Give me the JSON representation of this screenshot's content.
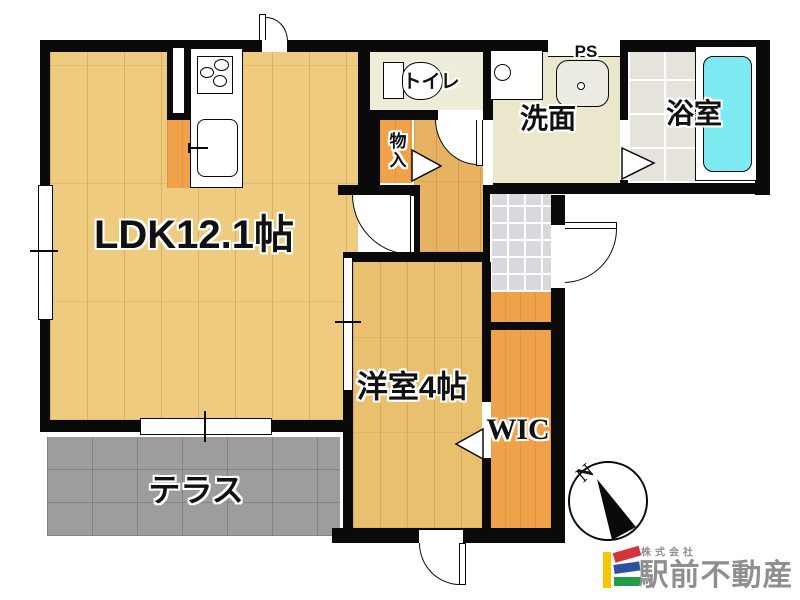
{
  "floorplan": {
    "rooms": {
      "ldk": {
        "label": "LDK12.1帖",
        "floor_type": "wood"
      },
      "western_room": {
        "label": "洋室4帖",
        "floor_type": "wood"
      },
      "wic": {
        "label": "WIC",
        "floor_type": "closet-wood"
      },
      "storage": {
        "label": "物入",
        "floor_type": "closet-wood"
      },
      "toilet": {
        "label": "トイレ"
      },
      "washroom": {
        "label": "洗面"
      },
      "bathroom": {
        "label": "浴室"
      },
      "pipe_space": {
        "label": "PS"
      },
      "terrace": {
        "label": "テラス"
      }
    },
    "fixtures": [
      "gas-stove-3-burner",
      "kitchen-sink",
      "kitchen-cabinet",
      "toilet-bowl",
      "washing-machine-pan",
      "vanity-basin",
      "bathtub",
      "shoe-cabinet",
      "sliding-door",
      "hinged-doors",
      "folding-door-triangles",
      "windows"
    ],
    "compass": {
      "north_label": "N"
    },
    "colors": {
      "wall": "#0a0a0a",
      "ldk_floor": "#eecb7e",
      "hall_floor": "#e7b261",
      "western_floor": "#e9c16e",
      "closet_orange": "#f0a24b",
      "toilet_floor": "#efecd9",
      "washroom_floor": "#eae7cc",
      "bathroom_tile": "#e5e3db",
      "genkan_tile": "#d8d8dd",
      "terrace": "#9d9d9d",
      "bathtub": "#7de9f0"
    }
  },
  "branding": {
    "company_prefix": "株式会社",
    "company_name": "駅前不動産",
    "text_color": "#8f8f8f",
    "logo_colors": {
      "yellow": "#f7c600",
      "red": "#d6333b",
      "blue": "#2b52a0",
      "green": "#1f9e46"
    }
  }
}
